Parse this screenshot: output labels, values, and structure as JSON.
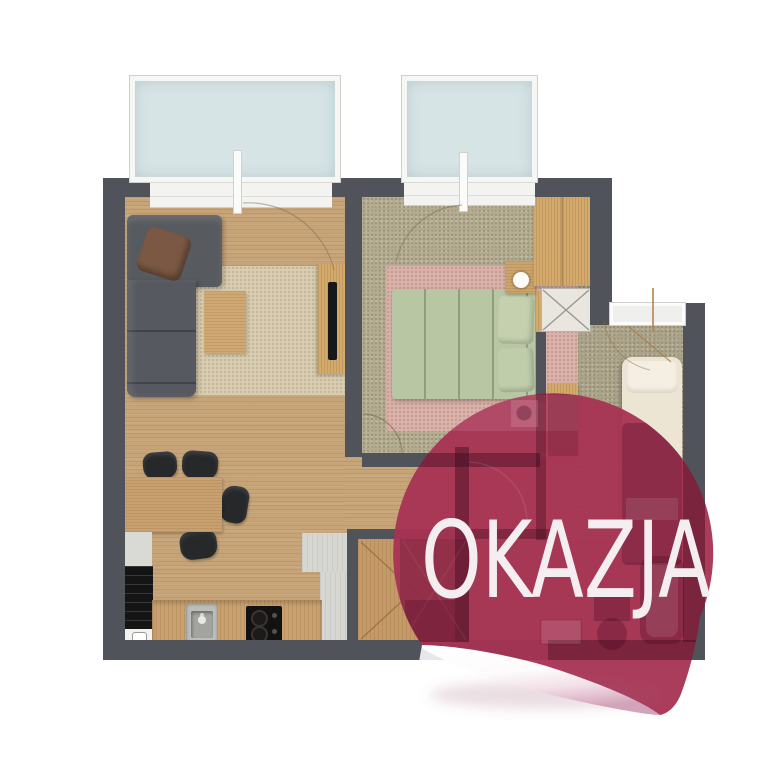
{
  "badge": {
    "label": "OKAZJA",
    "fill": "#a63353",
    "text_fill": "#f4eef0",
    "shape": "peeled-sticker-circle"
  },
  "colors": {
    "wall": "#50545a",
    "wood_floor": "#c6a478",
    "bedroom_carpet": "#b2aa8e",
    "small_room_carpet": "#aba388",
    "balcony_glass": "#d7e4e6",
    "living_rug": "#d9ccb0",
    "pink_rug": "#d8b2a9",
    "green_bed": "#b8c6a3",
    "cream_bed": "#ece5d3",
    "sofa": "#575a5e",
    "background": "#ffffff"
  },
  "floorplan": {
    "type": "apartment-top-view",
    "rooms": [
      {
        "id": "living-room",
        "furniture": [
          "corner-sofa",
          "sofa-pillow",
          "coffee-table",
          "area-rug",
          "tv-cabinet",
          "tv"
        ]
      },
      {
        "id": "dining-area",
        "furniture": [
          "dining-table",
          "chair",
          "chair",
          "chair",
          "chair"
        ]
      },
      {
        "id": "kitchen",
        "furniture": [
          "tall-black-appliance",
          "white-appliance",
          "counter",
          "sink",
          "cooktop"
        ]
      },
      {
        "id": "bedroom",
        "furniture": [
          "double-bed",
          "pillows",
          "pink-rug",
          "wardrobe",
          "nightstand",
          "lamp",
          "shaft"
        ]
      },
      {
        "id": "small-room",
        "furniture": [
          "single-bed",
          "side-cabinet",
          "small-window"
        ]
      },
      {
        "id": "bathroom",
        "furniture": [
          "washbasin",
          "toilet",
          "bathtub",
          "washing-machine"
        ]
      },
      {
        "id": "hallway",
        "furniture": [
          "wardrobe-doors",
          "tile-floor"
        ]
      }
    ],
    "balcony_windows": 2,
    "small_windows": 1
  }
}
